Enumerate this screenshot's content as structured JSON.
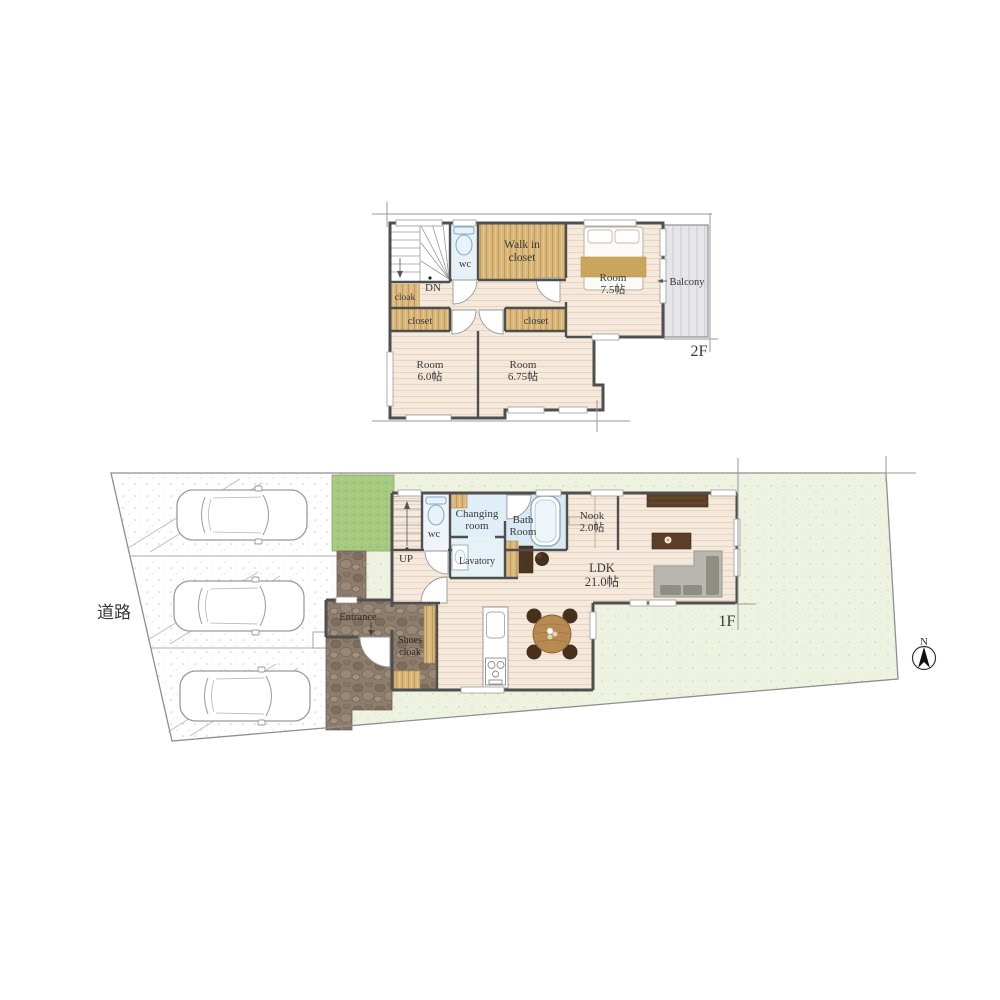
{
  "page": {
    "background": "#ffffff"
  },
  "palette": {
    "wall": "#4f4f4f",
    "floor_base": "#f5e9db",
    "floor_stripe": "#e8d4c3",
    "wood": "#d9b77c",
    "wood_grain": "#c19a54",
    "water_room_blue": "#dcebf5",
    "balcony_gray": "#e6e6ea",
    "yard_green": "#eef2e0",
    "garden_green": "#a6ca80",
    "stone_brown": "#8d7d6c",
    "furniture_dark": "#5a3e28",
    "sofa_gray": "#b8b8b0",
    "table_wood": "#b68a50",
    "boundary_gray": "#8f8f8f",
    "text": "#383838"
  },
  "floor2": {
    "label": "2F",
    "stairs_label": "DN",
    "wc_label": "wc",
    "walkin_closet": {
      "line1": "Walk in",
      "line2": "closet"
    },
    "cloak_label": "cloak",
    "closet_left_label": "closet",
    "closet_right_label": "closet",
    "room_75": {
      "line1": "Room",
      "line2": "7.5帖"
    },
    "balcony_label": "Balcony",
    "room_60": {
      "line1": "Room",
      "line2": "6.0帖"
    },
    "room_675": {
      "line1": "Room",
      "line2": "6.75帖"
    }
  },
  "floor1": {
    "label": "1F",
    "stairs_label": "UP",
    "wc_label": "wc",
    "changing_room": {
      "line1": "Changing",
      "line2": "room"
    },
    "bath_room": {
      "line1": "Bath",
      "line2": "Room"
    },
    "lavatory_label": "Lavatory",
    "nook": {
      "line1": "Nook",
      "line2": "2.0帖"
    },
    "ldk": {
      "line1": "LDK",
      "line2": "21.0帖"
    },
    "entrance_label": "Entrance",
    "shoes_cloak": {
      "line1": "Shoes",
      "line2": "cloak"
    },
    "study_label": "Study"
  },
  "site": {
    "road_label": "道路",
    "compass_label": "N"
  }
}
